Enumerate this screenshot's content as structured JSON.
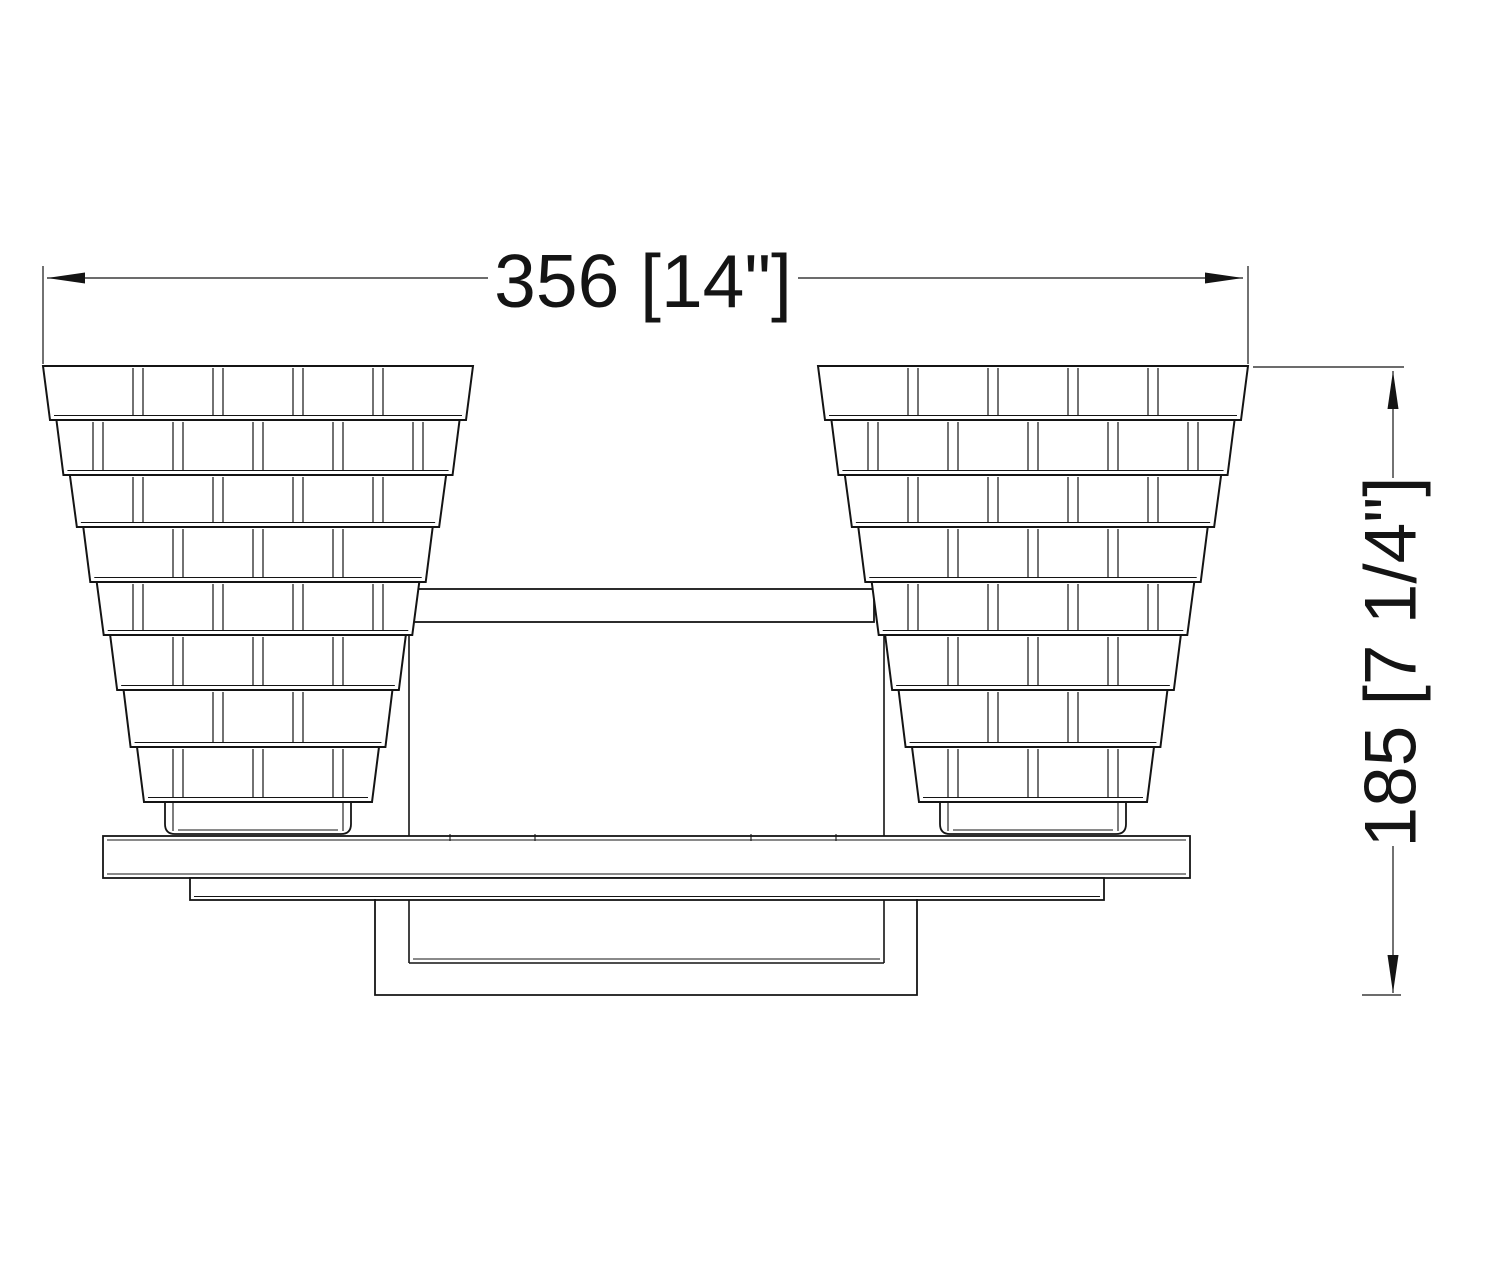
{
  "drawing": {
    "title": "Two-light tiered glass vanity fixture — front elevation",
    "background": "#ffffff",
    "line_color": "#141414",
    "canvas": {
      "width": 1500,
      "height": 1280
    },
    "dimensions": {
      "width": {
        "label": "356 [14\"]",
        "line_y": 278,
        "arrow_left_x": 47,
        "arrow_right_x": 1243,
        "gap_x1": 488,
        "gap_x2": 798,
        "text_x": 643,
        "text_y": 281,
        "font_size": 75,
        "ext_left_x": 43,
        "ext_right_x": 1248,
        "ext_y1": 266,
        "ext_y2": 364
      },
      "height": {
        "label": "185 [7 1/4\"]",
        "line_x": 1393,
        "arrow_top_y": 371,
        "arrow_bottom_y": 993,
        "gap_y1": 478,
        "gap_y2": 846,
        "text_x": 1391,
        "text_y": 662,
        "font_size": 73,
        "ext_top_y": 367,
        "ext_top_x1": 1253,
        "ext_top_x2": 1404,
        "tick_y": 995,
        "tick_x1": 1362,
        "tick_x2": 1401
      }
    },
    "shades": {
      "centers_x": [
        258,
        1033
      ],
      "tier_boundaries_y": [
        366,
        420,
        475,
        527,
        582,
        635,
        690,
        747,
        802
      ],
      "top_half_width": 215,
      "bottom_half_width": 121,
      "tier_bottom_taper": 7,
      "seam_spacing": 80,
      "seam_half_width": 5,
      "seam_edge_margin": 14
    },
    "cups": {
      "half_width": 93,
      "y_top": 797,
      "y_bottom": 834,
      "corner_radius": 10
    },
    "crossbar": {
      "x1": 412,
      "x2": 874,
      "y1": 589,
      "y2": 622
    },
    "housing": {
      "x1": 409,
      "x2": 884,
      "y1": 624,
      "y2": 963
    },
    "front_plate": {
      "x1": 103,
      "x2": 1190,
      "y1": 836,
      "y2": 878,
      "edge_inset": 4
    },
    "back_plate": {
      "x1": 190,
      "x2": 1104,
      "y1": 878,
      "y2": 900
    },
    "junction_box": {
      "x1": 375,
      "x2": 917,
      "y1": 899,
      "y2": 995
    },
    "plate_ticks_x": [
      450,
      535,
      751,
      836
    ]
  }
}
